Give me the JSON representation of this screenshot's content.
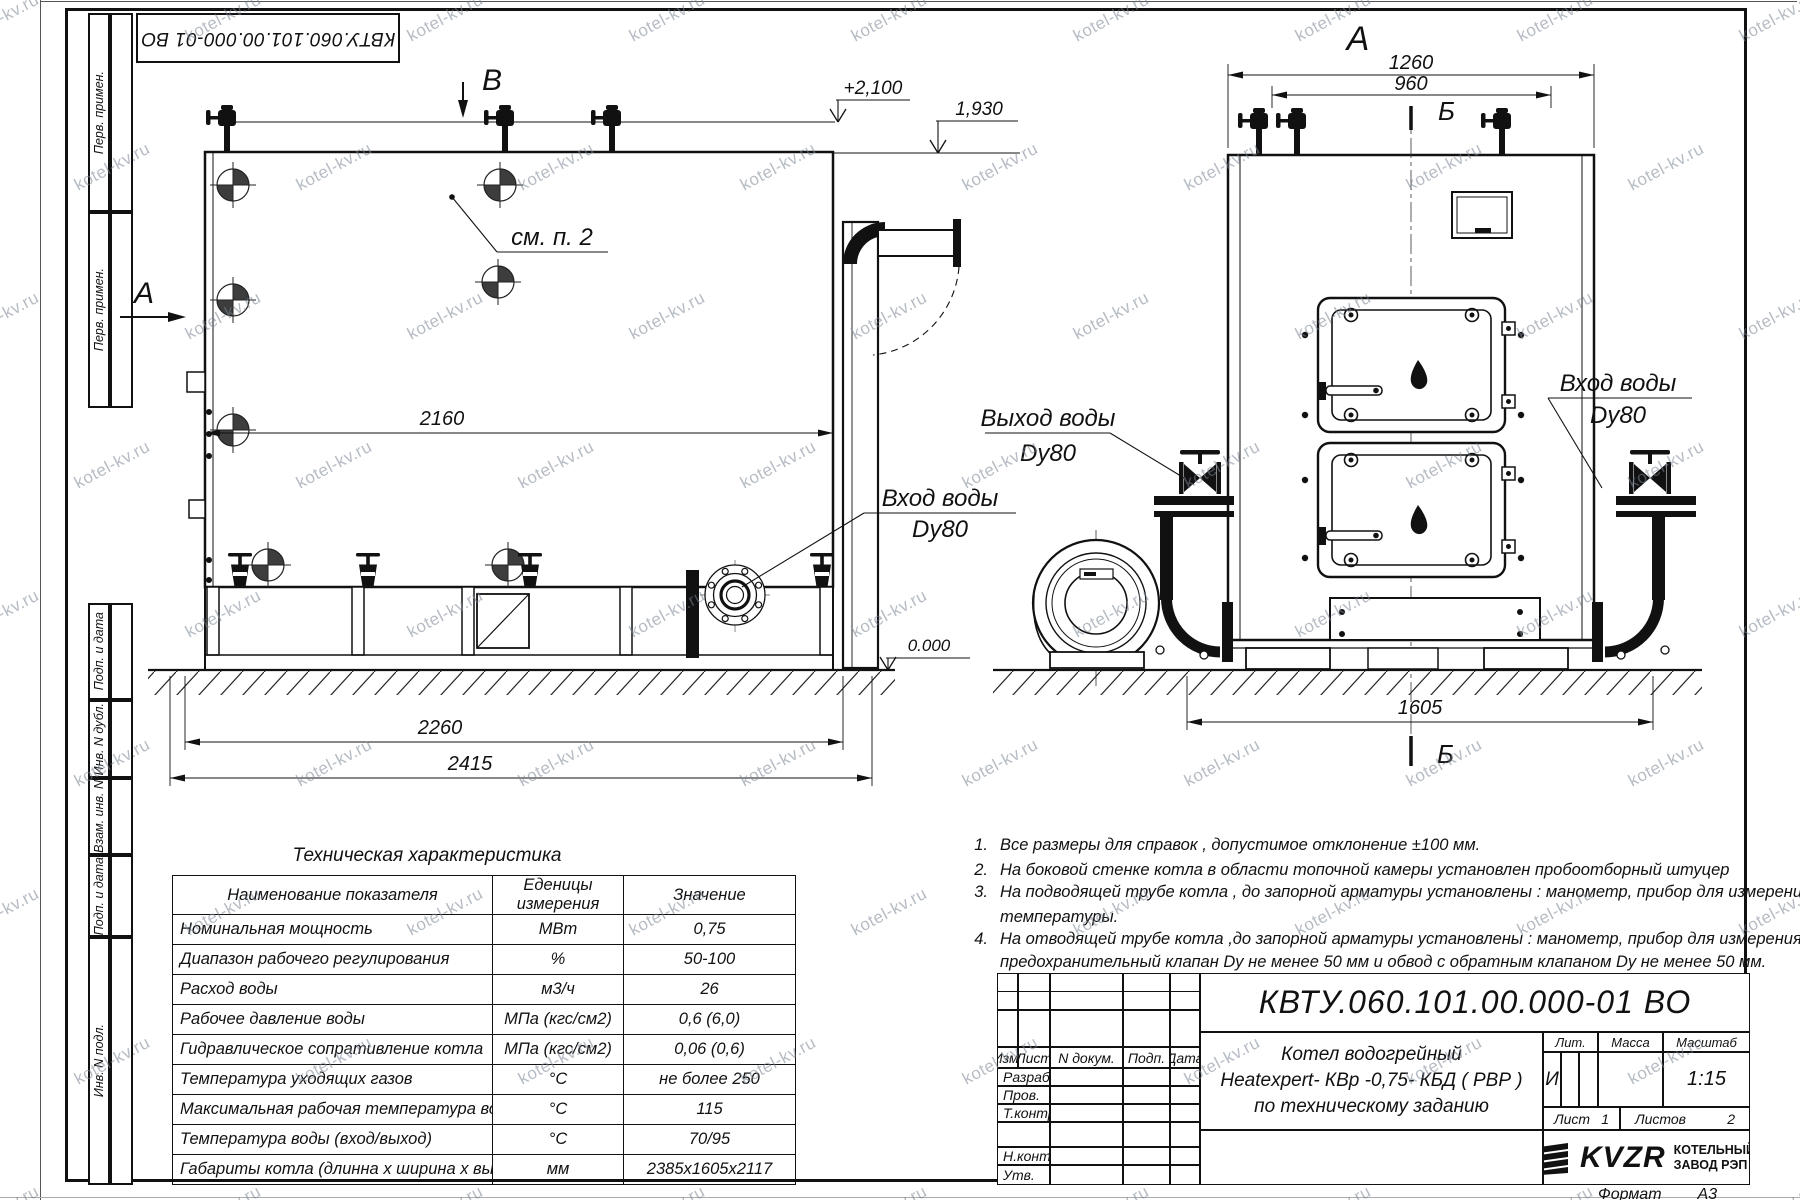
{
  "watermark": {
    "text": "kotel-kv.ru"
  },
  "corner_stamp": {
    "text": "КВТУ.060.101.00.000-01 ВО"
  },
  "margin": {
    "labels": [
      "Перв. примен.",
      "Перв. примен.",
      "Подп. и дата",
      "Инв. N дубл.",
      "Взам. инв. N",
      "Подп. и дата",
      "Инв. N подл."
    ]
  },
  "side_view": {
    "section_top": "B",
    "section_left": "А",
    "callout": "см. п. 2",
    "dim_inner": "2160",
    "dim_frame": "2260",
    "dim_overall": "2415",
    "elev_top": "+2,100",
    "elev_mid": "1,930",
    "elev_zero": "0.000",
    "inlet": {
      "line1": "Вход воды",
      "line2": "Dy80"
    }
  },
  "front_view": {
    "view_label": "А",
    "dim_outer": "1260",
    "dim_inner": "960",
    "section_mark_top": "Б",
    "section_mark_bottom": "Б",
    "dim_base": "1605",
    "outlet": {
      "line1": "Выход воды",
      "line2": "Dy80"
    },
    "inlet": {
      "line1": "Вход воды",
      "line2": "Dy80"
    }
  },
  "notes": {
    "lines": [
      {
        "num": "1.",
        "text": "Все размеры для справок , допустимое отклонение  ±100 мм."
      },
      {
        "num": "2.",
        "text": "На боковой стенке котла в области топочной камеры установлен пробоотборный штуцер"
      },
      {
        "num": "3.",
        "text": "На  подводящей трубе котла , до запорной арматуры установлены : манометр, прибор для измерения"
      },
      {
        "num": "",
        "text": "температуры."
      },
      {
        "num": "4.",
        "text": "На отводящей трубе котла ,до запорной арматуры установлены : манометр, прибор для измерения температуры,"
      },
      {
        "num": "",
        "text": "предохранительный клапан  Dу не менее  50 мм и обвод с обратным клапаном  Dу не менее  50 мм."
      }
    ]
  },
  "spec_table": {
    "title": "Техническая характеристика",
    "col1_header": "Наименование показателя",
    "col2_header_line1": "Еденицы",
    "col2_header_line2": "измерения",
    "col3_header": "Значение",
    "rows": [
      [
        "Номинальная мощность",
        "МВт",
        "0,75"
      ],
      [
        "Диапазон рабочего регулирования",
        "%",
        "50-100"
      ],
      [
        "Расход воды",
        "м3/ч",
        "26"
      ],
      [
        "Рабочее давление воды",
        "МПа (кгс/см2)",
        "0,6 (6,0)"
      ],
      [
        "Гидравлическое сопративление котла",
        "МПа (кгс/см2)",
        "0,06 (0,6)"
      ],
      [
        "Температура уходящих газов",
        "°С",
        "не более 250"
      ],
      [
        "Максимальная рабочая температура воды",
        "°С",
        "115"
      ],
      [
        "Температура воды (вход/выход)",
        "°С",
        "70/95"
      ],
      [
        "Габариты котла (длинна х ширина х высота)",
        "мм",
        "2385х1605х2117"
      ]
    ]
  },
  "title_block": {
    "doc_number": "КВТУ.060.101.00.000-01 ВО",
    "cols": [
      "Изм.",
      "Лист",
      "N докум.",
      "Подп.",
      "Дата"
    ],
    "rows": [
      "Разраб.",
      "Пров.",
      "Т.контр.",
      "",
      "Н.контр.",
      "Утв."
    ],
    "name_line1": "Котел водогрейный",
    "name_line2": "Heatexpert- КВр -0,75- КБД ( РВР )",
    "name_line3": "по техническому заданию",
    "lit_label": "Лит.",
    "lit_value": "И",
    "mass_label": "Масса",
    "scale_label": "Масштаб",
    "scale_value": "1:15",
    "sheet_label": "Лист",
    "sheet_value": "1",
    "sheets_label": "Листов",
    "sheets_value": "2",
    "logo": "KVZR",
    "company_line1": "КОТЕЛЬНЫЙ",
    "company_line2": "ЗАВОД РЭП",
    "format_label": "Формат",
    "format_value": "А3"
  }
}
